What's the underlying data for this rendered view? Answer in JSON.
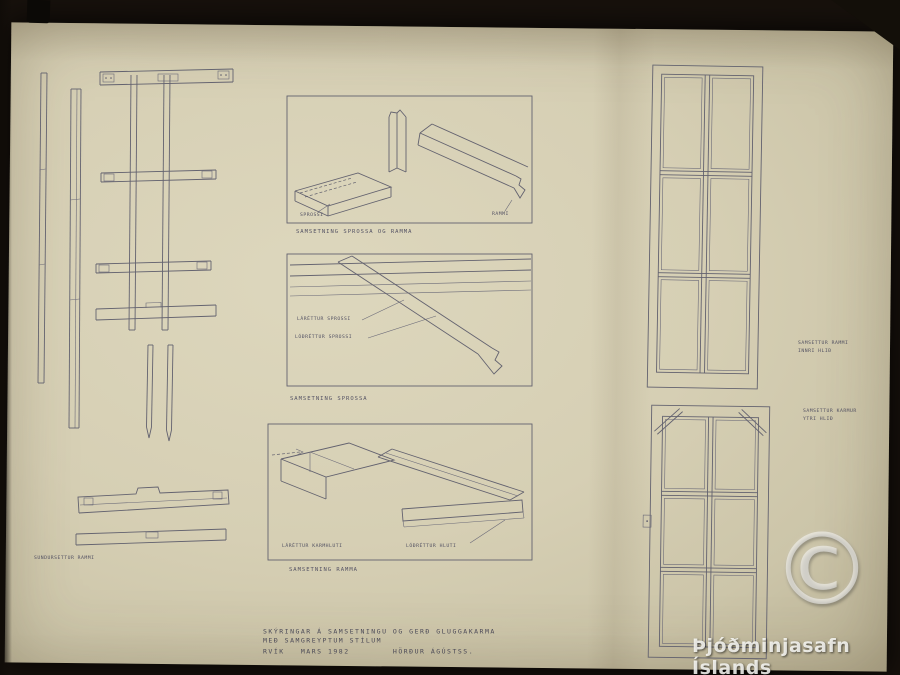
{
  "colors": {
    "background": "#17110c",
    "paper": "#d7d1b6",
    "ink": "#5d5c6c",
    "watermark": "#ffffff"
  },
  "drawings": {
    "exploded_frame": {
      "caption": "SUNDURSETTUR RAMMI"
    },
    "detail_sprossa_ramma": {
      "caption": "SAMSETNING SPROSSA OG RAMMA",
      "label_sprossi": "SPROSSI",
      "label_rammi": "RAMMI"
    },
    "detail_sprossa": {
      "caption": "SAMSETNING SPROSSA",
      "label_horizontal": "LÁRÉTTUR SPROSSI",
      "label_vertical": "LÓÐRÉTTUR SPROSSI"
    },
    "detail_ramma": {
      "caption": "SAMSETNING RAMMA",
      "label_horizontal": "LÁRÉTTUR KARMHLUTI",
      "label_vertical": "LÓÐRÉTTUR HLUTI"
    },
    "window_inner": {
      "caption_line1": "SAMSETTUR RAMMI",
      "caption_line2": "INNRI HLIÐ"
    },
    "window_outer": {
      "caption_line1": "SAMSETTUR KARMUR",
      "caption_line2": "YTRI HLIÐ"
    }
  },
  "title_block": {
    "line1": "SKÝRINGAR Á SAMSETNINGU OG GERÐ GLUGGAKARMA",
    "line2": "MEÐ SAMGREYPTUM STÍLUM",
    "line3": "RVÍK   MARS 1982        HÖRÐUR ÁGÚSTSS."
  },
  "watermark": {
    "symbol": "©",
    "text": "Þjóðminjasafn Íslands"
  }
}
